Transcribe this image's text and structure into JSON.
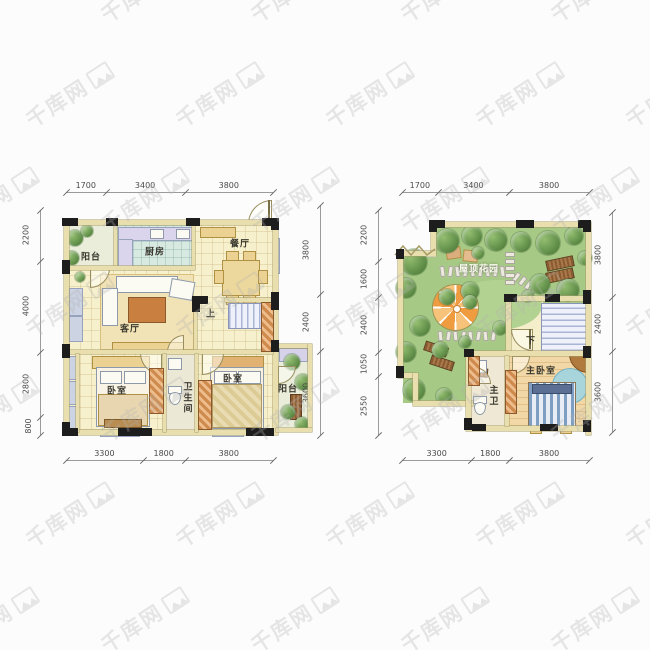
{
  "watermark": {
    "text": "千库网"
  },
  "plan_left": {
    "labels": {
      "balcony_tl": "阳台",
      "kitchen": "厨房",
      "dining": "餐厅",
      "living": "客厅",
      "bedroom_left": "卧室",
      "bathroom": "卫生间",
      "bedroom_right": "卧室",
      "balcony_right": "阳台",
      "stairs_up": "上"
    },
    "dims_top": [
      "1700",
      "3400",
      "3800"
    ],
    "dims_left": [
      "2200",
      "4000",
      "2800",
      "800"
    ],
    "dims_bottom": [
      "3300",
      "1800",
      "3800"
    ],
    "dims_right": [
      "3800",
      "2400",
      "3600"
    ]
  },
  "plan_right": {
    "labels": {
      "garden": "屋顶花园",
      "stairs_down": "下",
      "master_bedroom": "主卧室",
      "master_bath": "主卫"
    },
    "dims_top": [
      "1700",
      "3400",
      "3800"
    ],
    "dims_left": [
      "2200",
      "1600",
      "2400",
      "1050",
      "2550"
    ],
    "dims_bottom": [
      "3300",
      "1800",
      "3800"
    ],
    "dims_right": [
      "3800",
      "2400",
      "3600"
    ]
  }
}
